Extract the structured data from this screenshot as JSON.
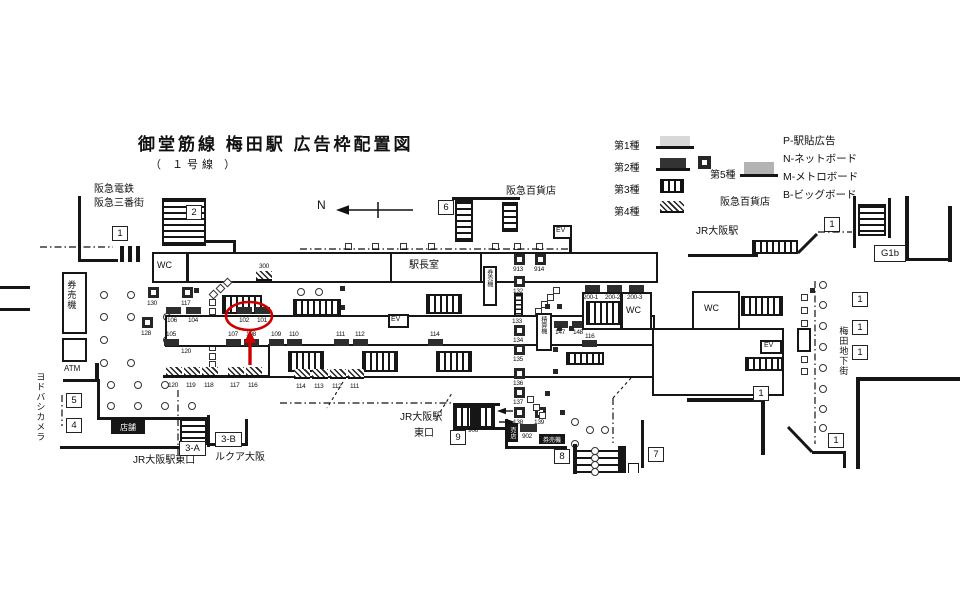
{
  "title": {
    "main": "御堂筋線 梅田駅 広告枠配置図",
    "sub": "（ １号線 ）"
  },
  "compass": {
    "north": "N"
  },
  "legend": {
    "type1": "第1種",
    "type2": "第2種",
    "type3": "第3種",
    "type4": "第4種",
    "type5": "第5種",
    "codes": [
      "P-駅貼広告",
      "N-ネットボード",
      "M-メトロボード",
      "B-ビッグボード"
    ]
  },
  "places": {
    "hankyu_railway": "阪急電鉄",
    "hankyu_sanbangai": "阪急三番街",
    "hankyu_dept": "阪急百貨店",
    "jr_osaka": "JR大阪駅",
    "jr_osaka_east": "JR大阪駅東口",
    "jr_l1": "JR大阪駅",
    "jr_l2": "東口",
    "lucua": "ルクア大阪",
    "yodobashi": "ヨドバシカメラ",
    "umeda_chikagai": "梅田地下街"
  },
  "rooms": {
    "wc": "WC",
    "ev": "EV",
    "station_master": "駅長室",
    "ticket_machine": "券売機",
    "fare_adjustment": "精算機",
    "kiosk": "売店",
    "shop": "店舗",
    "atm": "ATM"
  },
  "entrances": {
    "n1": "1",
    "n2": "2",
    "n3a": "3-A",
    "n3b": "3-B",
    "n4": "4",
    "n5": "5",
    "n6": "6",
    "n7": "7",
    "n8": "8",
    "n9": "9",
    "g1b": "G1b"
  },
  "ads": {
    "row_top": [
      "106",
      "104",
      "102",
      "101"
    ],
    "row_mid": [
      "105",
      "107",
      "108",
      "109",
      "110",
      "111",
      "112",
      "114"
    ],
    "row_bottom": [
      "120",
      "119",
      "118",
      "117",
      "116",
      "114",
      "113",
      "112",
      "111"
    ],
    "corridor_300": "300",
    "row_200": [
      "200-1",
      "200-2",
      "200-3"
    ],
    "pair_147": [
      "147",
      "148"
    ],
    "ad_116": "116",
    "center_column": [
      "913",
      "914",
      "132",
      "133",
      "134",
      "135",
      "136",
      "137",
      "138",
      "139"
    ],
    "left_pillars": [
      "130",
      "117",
      "128",
      "120"
    ],
    "ad_902": "902",
    "ad_906": "906"
  },
  "annotation": {
    "highlighted_ad": "101"
  }
}
